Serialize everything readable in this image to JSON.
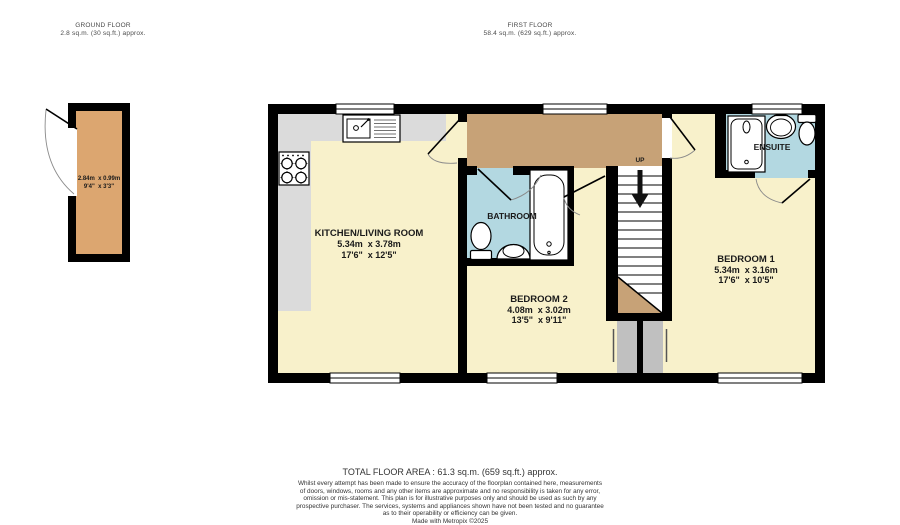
{
  "colors": {
    "wall": "#000000",
    "cream": "#F8F1CB",
    "landing": "#C7A277",
    "store": "#DCA670",
    "wet": "#B3D8E1",
    "counter": "#DBDBDB",
    "cupboard": "#C0C0C0",
    "ink": "#1A1A1A",
    "muted": "#4A4A4A"
  },
  "header": {
    "ground_floor": {
      "title": "GROUND FLOOR",
      "area": "2.8 sq.m. (30 sq.ft.) approx."
    },
    "first_floor": {
      "title": "FIRST FLOOR",
      "area": "58.4 sq.m. (629 sq.ft.) approx."
    }
  },
  "rooms": {
    "store": {
      "dims_m": "2.84m  x 0.99m",
      "dims_ft": "9'4\"  x 3'3\""
    },
    "kitchen_living": {
      "name": "KITCHEN/LIVING ROOM",
      "dims_m": "5.34m  x 3.78m",
      "dims_ft": "17'6\"  x 12'5\""
    },
    "bathroom": {
      "name": "BATHROOM"
    },
    "bedroom2": {
      "name": "BEDROOM 2",
      "dims_m": "4.08m  x 3.02m",
      "dims_ft": "13'5\"  x 9'11\""
    },
    "bedroom1": {
      "name": "BEDROOM 1",
      "dims_m": "5.34m  x 3.16m",
      "dims_ft": "17'6\"  x 10'5\""
    },
    "ensuite": {
      "name": "ENSUITE"
    },
    "stairs": {
      "up": "UP"
    }
  },
  "footer": {
    "total_area": "TOTAL FLOOR AREA : 61.3 sq.m. (659 sq.ft.) approx.",
    "disclaimer_lines": [
      "Whilst every attempt has been made to ensure the accuracy of the floorplan contained here, measurements",
      "of doors, windows, rooms and any other items are approximate and no responsibility is taken for any error,",
      "omission or mis-statement. This plan is for illustrative purposes only and should be used as such by any",
      "prospective purchaser. The services, systems and appliances shown have not been tested and no guarantee",
      "as to their operability or efficiency can be given."
    ],
    "credit": "Made with Metropix ©2025"
  }
}
